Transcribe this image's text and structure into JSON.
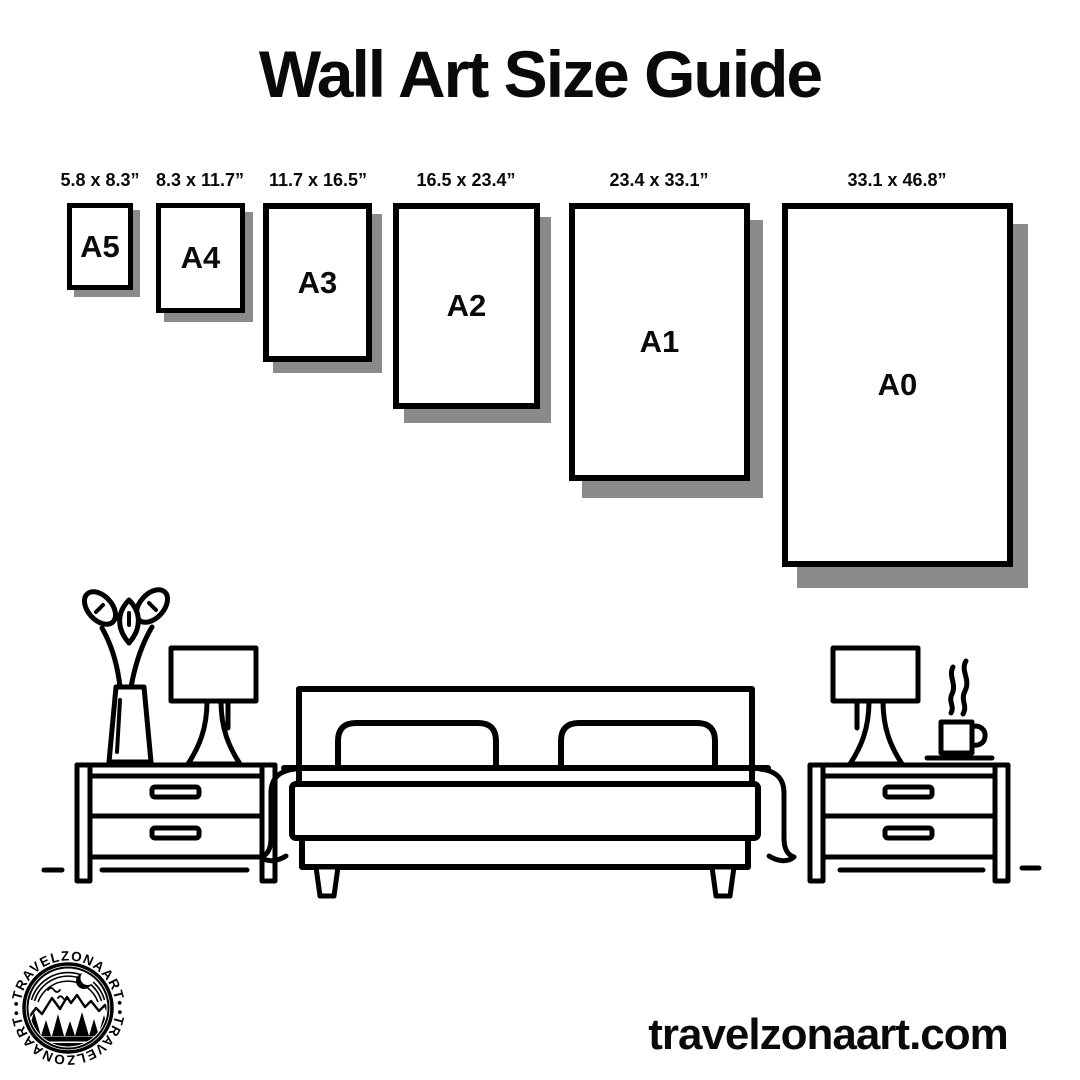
{
  "title": "Wall Art Size Guide",
  "sizes": [
    {
      "name": "A5",
      "dimensions": "5.8 x 8.3”"
    },
    {
      "name": "A4",
      "dimensions": "8.3 x 11.7”"
    },
    {
      "name": "A3",
      "dimensions": "11.7 x 16.5”"
    },
    {
      "name": "A2",
      "dimensions": "16.5 x 23.4”"
    },
    {
      "name": "A1",
      "dimensions": "23.4 x 33.1”"
    },
    {
      "name": "A0",
      "dimensions": "33.1 x 46.8”"
    }
  ],
  "brand": {
    "website": "travelzonaart.com",
    "logo_ring_text_top": "•TRAVELZONAART•",
    "logo_ring_text_bottom": "•TRAVELZONAART•"
  },
  "colors": {
    "ink": "#000000",
    "frame_shadow": "#8a8a8a",
    "background": "#ffffff"
  },
  "illustration": {
    "description": "black line-art bedroom scene",
    "items": [
      "flower-vase",
      "table-lamp",
      "nightstand",
      "double-bed",
      "nightstand",
      "table-lamp",
      "coffee-cup"
    ]
  }
}
